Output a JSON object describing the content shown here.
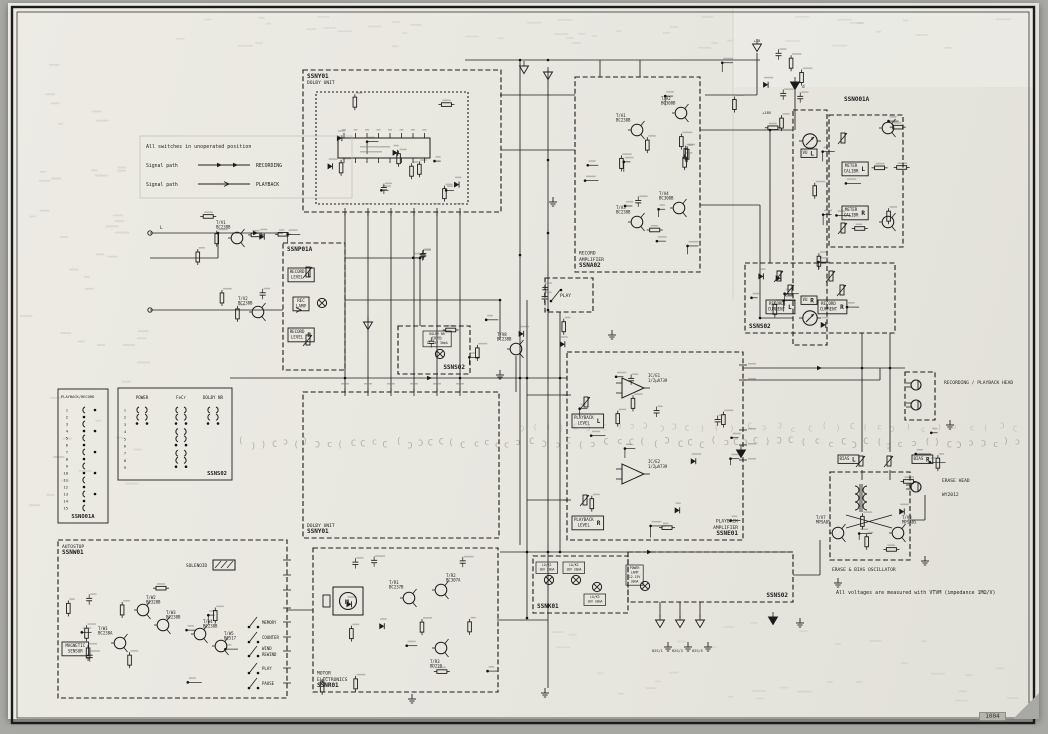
{
  "sheet": {
    "tag": "1004"
  },
  "legend": {
    "title": "All switches in unoperated position",
    "entries": [
      {
        "label": "Signal path",
        "arrow": "filled",
        "text": "RECORDING"
      },
      {
        "label": "Signal path",
        "arrow": "open",
        "text": "PLAYBACK"
      }
    ]
  },
  "note": "All voltages are measured with VTVM (impedance 1MΩ/V)",
  "diagram": {
    "blocks": [
      {
        "id": "SSNY01",
        "sub": [
          "DOLBY UNIT"
        ],
        "x": 303,
        "y": 70,
        "w": 198,
        "h": 142,
        "lp": "tl"
      },
      {
        "id": "",
        "sub": [],
        "x": 316,
        "y": 92,
        "w": 152,
        "h": 112,
        "lp": "tl",
        "dotted": true
      },
      {
        "id": "SSNP01A",
        "sub": [],
        "x": 283,
        "y": 243,
        "w": 62,
        "h": 127,
        "lp": "tl"
      },
      {
        "id": "SSNS02",
        "sub": [],
        "x": 398,
        "y": 326,
        "w": 72,
        "h": 48,
        "lp": "br"
      },
      {
        "id": "",
        "sub": [],
        "x": 545,
        "y": 278,
        "w": 48,
        "h": 34,
        "lp": "tl"
      },
      {
        "id": "SSNA02",
        "sub": [
          "RECORD",
          "AMPLIFIER"
        ],
        "x": 575,
        "y": 77,
        "w": 125,
        "h": 195,
        "lp": "bl",
        "subFirst": true
      },
      {
        "id": "",
        "sub": [],
        "x": 793,
        "y": 110,
        "w": 34,
        "h": 235,
        "lp": "tl"
      },
      {
        "id": "",
        "sub": [],
        "x": 829,
        "y": 115,
        "w": 74,
        "h": 132,
        "lp": "tl"
      },
      {
        "id": "SSNS02",
        "sub": [],
        "x": 745,
        "y": 263,
        "w": 150,
        "h": 70,
        "lp": "bl"
      },
      {
        "id": "SSNE01",
        "sub": [
          "PLAYBACK",
          "AMPLIFIER"
        ],
        "x": 567,
        "y": 352,
        "w": 176,
        "h": 188,
        "lp": "br",
        "subFirst": true
      },
      {
        "id": "SSNY01",
        "sub": [
          "DOLBY UNIT"
        ],
        "x": 303,
        "y": 392,
        "w": 196,
        "h": 146,
        "lp": "bl",
        "subFirst": true
      },
      {
        "id": "SSNW01",
        "sub": [
          "AUTOSTOP"
        ],
        "x": 58,
        "y": 540,
        "w": 229,
        "h": 158,
        "lp": "tl",
        "subFirst": true
      },
      {
        "id": "SSNR01",
        "sub": [
          "MOTOR",
          "ELECTRONICS"
        ],
        "x": 313,
        "y": 548,
        "w": 185,
        "h": 144,
        "lp": "bl",
        "subFirst": true
      },
      {
        "id": "SSNK01",
        "sub": [],
        "x": 533,
        "y": 556,
        "w": 95,
        "h": 57,
        "lp": "bl"
      },
      {
        "id": "SSNS02",
        "sub": [],
        "x": 628,
        "y": 552,
        "w": 165,
        "h": 50,
        "lp": "br"
      },
      {
        "id": "",
        "sub": [],
        "x": 830,
        "y": 472,
        "w": 80,
        "h": 88,
        "lp": "tl"
      },
      {
        "id": "",
        "sub": [],
        "x": 905,
        "y": 372,
        "w": 30,
        "h": 48,
        "lp": "tl"
      }
    ],
    "panels": {
      "playback_record": {
        "title": "PLAYBACK/RECORD",
        "rows": 15,
        "id": "SSNO01A",
        "x": 58,
        "y": 389,
        "w": 50,
        "h": 134
      },
      "function_switches": {
        "rows": 9,
        "id": "SSNS02",
        "x": 118,
        "y": 388,
        "w": 114,
        "h": 92,
        "columns": [
          {
            "label": "POWER",
            "pairs": [
              1
            ]
          },
          {
            "label": "FeCr",
            "pairs": [
              1,
              4,
              7
            ]
          },
          {
            "label": "DOLBY NR",
            "pairs": [
              1
            ]
          }
        ]
      }
    },
    "boxed_labels": [
      {
        "lines": [
          "RECORD",
          "LEVEL"
        ],
        "letter": "L",
        "x": 288,
        "y": 268
      },
      {
        "lines": [
          "REC",
          "LAMP"
        ],
        "letter": "",
        "x": 293,
        "y": 297
      },
      {
        "lines": [
          "RECORD",
          "LEVEL"
        ],
        "letter": "R",
        "x": 288,
        "y": 328
      },
      {
        "lines": [
          "VU"
        ],
        "letter": "L",
        "x": 801,
        "y": 149
      },
      {
        "lines": [
          "VU"
        ],
        "letter": "R",
        "x": 801,
        "y": 296
      },
      {
        "lines": [
          "METER",
          "CALIBR"
        ],
        "letter": "L",
        "x": 842,
        "y": 162
      },
      {
        "lines": [
          "METER",
          "CALIBR"
        ],
        "letter": "R",
        "x": 842,
        "y": 206
      },
      {
        "lines": [
          "RECORD",
          "CURRENT"
        ],
        "letter": "L",
        "x": 766,
        "y": 300
      },
      {
        "lines": [
          "RECORD",
          "CURRENT"
        ],
        "letter": "R",
        "x": 818,
        "y": 300
      },
      {
        "lines": [
          "PLAYBACK",
          "LEVEL"
        ],
        "letter": "L",
        "x": 572,
        "y": 414
      },
      {
        "lines": [
          "PLAYBACK",
          "LEVEL"
        ],
        "letter": "R",
        "x": 572,
        "y": 516
      },
      {
        "lines": [
          "BIAS"
        ],
        "letter": "L",
        "x": 838,
        "y": 455
      },
      {
        "lines": [
          "BIAS"
        ],
        "letter": "R",
        "x": 912,
        "y": 455
      },
      {
        "lines": [
          "MAGNETIC",
          "SENSOR"
        ],
        "letter": "",
        "x": 62,
        "y": 642
      }
    ],
    "lamp_boxes": [
      {
        "lines": [
          "LA/K1",
          "18V 30mA"
        ],
        "x": 536,
        "y": 562
      },
      {
        "lines": [
          "LA/K2",
          "18V 30mA"
        ],
        "x": 563,
        "y": 562
      },
      {
        "lines": [
          "LA/K3",
          "18V 30mA"
        ],
        "x": 584,
        "y": 594
      },
      {
        "lines": [
          "DOLBY NR",
          "LA/S2",
          "12-15V 30mA"
        ],
        "x": 423,
        "y": 331
      },
      {
        "lines": [
          "POWER",
          "LAMP",
          "12-15V",
          "30mA"
        ],
        "x": 626,
        "y": 565
      }
    ],
    "labels": [
      {
        "t": "SSNO01A",
        "x": 844,
        "y": 101,
        "s": 6,
        "b": 1
      },
      {
        "t": "SOLENOID",
        "x": 186,
        "y": 567,
        "s": 4.4
      },
      {
        "t": "MEMORY",
        "x": 262,
        "y": 624,
        "s": 4
      },
      {
        "t": "COUNTER",
        "x": 262,
        "y": 639,
        "s": 4
      },
      {
        "t": "WIND",
        "x": 262,
        "y": 650,
        "s": 4
      },
      {
        "t": "REWIND",
        "x": 262,
        "y": 656,
        "s": 4
      },
      {
        "t": "PLAY",
        "x": 262,
        "y": 670,
        "s": 4
      },
      {
        "t": "PAUSE",
        "x": 262,
        "y": 685,
        "s": 4
      },
      {
        "t": "PLAY",
        "x": 560,
        "y": 297,
        "s": 4.6
      },
      {
        "t": "RECORDING / PLAYBACK  HEAD",
        "x": 944,
        "y": 384,
        "s": 4.6
      },
      {
        "t": "ERASE  HEAD",
        "x": 942,
        "y": 482,
        "s": 4.6
      },
      {
        "t": "WY2012",
        "x": 942,
        "y": 496,
        "s": 4.6
      },
      {
        "t": "ERASE & BIAS  OSCILLATOR",
        "x": 832,
        "y": 571,
        "s": 4.6
      },
      {
        "t": "H2S/1",
        "x": 652,
        "y": 652,
        "s": 3.6
      },
      {
        "t": "H2S/3",
        "x": 672,
        "y": 652,
        "s": 3.6
      },
      {
        "t": "H2S/5",
        "x": 692,
        "y": 652,
        "s": 3.6
      },
      {
        "t": "L",
        "x": 160,
        "y": 229,
        "s": 4.6
      },
      {
        "t": "+18V",
        "x": 762,
        "y": 114,
        "s": 3.8
      },
      {
        "t": "M",
        "x": 345,
        "y": 604,
        "s": 6.5,
        "b": 1
      },
      {
        "t": "IC/E1",
        "x": 648,
        "y": 377,
        "s": 4
      },
      {
        "t": "1/2µA739",
        "x": 648,
        "y": 382,
        "s": 4
      },
      {
        "t": "IC/E2",
        "x": 648,
        "y": 463,
        "s": 4
      },
      {
        "t": "1/2µA739",
        "x": 648,
        "y": 468,
        "s": 4
      }
    ],
    "transistors": [
      [
        "T/V1",
        "BC238B",
        237,
        238,
        216,
        224
      ],
      [
        "T/V2",
        "BC238B",
        258,
        312,
        238,
        300
      ],
      [
        "T/V8",
        "BC238B",
        516,
        349,
        497,
        336
      ],
      [
        "T/A1",
        "BC238B",
        637,
        130,
        616,
        117
      ],
      [
        "T/A2",
        "BC308B",
        681,
        113,
        661,
        100
      ],
      [
        "T/A3",
        "BC238B",
        637,
        222,
        616,
        209
      ],
      [
        "T/A4",
        "BC308B",
        679,
        208,
        659,
        195
      ],
      [
        "T/W1",
        "BC238A",
        120,
        643,
        98,
        630
      ],
      [
        "T/W2",
        "BC328B",
        143,
        610,
        146,
        599
      ],
      [
        "T/W3",
        "BC238B",
        163,
        625,
        166,
        614
      ],
      [
        "T/W4",
        "BC238B",
        200,
        634,
        203,
        623
      ],
      [
        "T/W5",
        "BC517",
        221,
        646,
        224,
        635
      ],
      [
        "T/R1",
        "BC237B",
        409,
        598,
        389,
        584
      ],
      [
        "T/R2",
        "BC307A",
        441,
        590,
        446,
        577
      ],
      [
        "T/R3",
        "BD220",
        441,
        648,
        430,
        663
      ],
      [
        "T/V7",
        "MPSA05",
        838,
        533,
        816,
        519
      ],
      [
        "T/V8",
        "MPSA05",
        898,
        533,
        902,
        519
      ],
      [
        "",
        "",
        888,
        128,
        0,
        0
      ],
      [
        "",
        "",
        888,
        222,
        0,
        0
      ]
    ],
    "opamps": [
      [
        622,
        388
      ],
      [
        622,
        474
      ]
    ],
    "meters": [
      [
        810,
        141
      ],
      [
        810,
        318
      ]
    ],
    "lamps": [
      [
        322,
        303
      ],
      [
        440,
        354
      ],
      [
        549,
        580
      ],
      [
        576,
        580
      ],
      [
        597,
        587
      ],
      [
        645,
        586
      ]
    ],
    "heads": [
      [
        916,
        385
      ],
      [
        916,
        405
      ],
      [
        916,
        487
      ]
    ],
    "pots": [
      [
        308,
        272
      ],
      [
        308,
        340
      ],
      [
        586,
        402
      ],
      [
        585,
        500
      ],
      [
        843,
        138
      ],
      [
        843,
        228
      ],
      [
        779,
        276
      ],
      [
        790,
        290
      ],
      [
        831,
        276
      ],
      [
        842,
        290
      ],
      [
        861,
        461
      ],
      [
        889,
        461
      ]
    ],
    "flags": [
      {
        "x": 548,
        "y": 72,
        "t": ""
      },
      {
        "x": 524,
        "y": 66,
        "t": ""
      },
      {
        "x": 757,
        "y": 44,
        "t": "+18"
      },
      {
        "x": 795,
        "y": 82,
        "t": "d",
        "filled": true
      },
      {
        "x": 368,
        "y": 322,
        "t": ""
      },
      {
        "x": 741,
        "y": 450,
        "t": "",
        "filled": true
      },
      {
        "x": 660,
        "y": 620,
        "t": ""
      },
      {
        "x": 680,
        "y": 620,
        "t": ""
      },
      {
        "x": 700,
        "y": 620,
        "t": ""
      },
      {
        "x": 773,
        "y": 617,
        "t": "",
        "filled": true
      }
    ],
    "grounds": [
      [
        553,
        197
      ],
      [
        612,
        330
      ],
      [
        500,
        370
      ],
      [
        668,
        642
      ],
      [
        688,
        642
      ],
      [
        708,
        642
      ],
      [
        545,
        688
      ],
      [
        412,
        694
      ],
      [
        838,
        578
      ],
      [
        925,
        556
      ],
      [
        950,
        420
      ],
      [
        800,
        618
      ]
    ]
  }
}
